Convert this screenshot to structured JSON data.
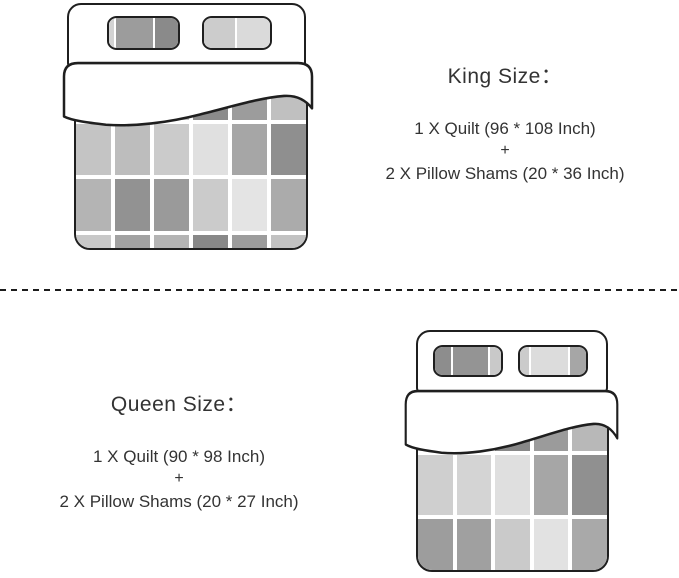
{
  "background": "#ffffff",
  "outline_color": "#1f1f1f",
  "text_color": "#333333",
  "sections": {
    "king": {
      "title": "King Size：",
      "quilt_line": "1 X Quilt (96 * 108 Inch)",
      "plus": "+",
      "shams_line": "2 X Pillow Shams (20 * 36 Inch)"
    },
    "queen": {
      "title": "Queen Size：",
      "quilt_line": "1 X Quilt (90 * 98 Inch)",
      "plus": "+",
      "shams_line": "2 X Pillow Shams (20 * 27 Inch)"
    }
  },
  "beds": {
    "king": {
      "pillows": [
        {
          "segments": [
            {
              "color": "#d3d3d3",
              "grow": 8
            },
            {
              "color": "#9c9c9c",
              "grow": 56
            },
            {
              "color": "#8a8a8a",
              "grow": 36
            }
          ]
        },
        {
          "segments": [
            {
              "color": "#cccccc",
              "grow": 48
            },
            {
              "color": "#dadada",
              "grow": 52
            }
          ]
        }
      ],
      "quilt": {
        "columns": 6,
        "row_heights": [
          30,
          51,
          52,
          13
        ],
        "rows": [
          [
            "#b2b2b2",
            "#a9a9a9",
            "#c2c2c2",
            "#8b8b8b",
            "#9c9c9c",
            "#c0c0c0"
          ],
          [
            "#c4c4c4",
            "#bdbdbd",
            "#cbcbcb",
            "#e0e0e0",
            "#a6a6a6",
            "#8f8f8f"
          ],
          [
            "#b4b4b4",
            "#929292",
            "#9a9a9a",
            "#cbcbcb",
            "#e4e4e4",
            "#ababab"
          ],
          [
            "#c8c8c8",
            "#a2a2a2",
            "#b4b4b4",
            "#888888",
            "#9c9c9c",
            "#c2c2c2"
          ]
        ]
      }
    },
    "queen": {
      "pillows": [
        {
          "segments": [
            {
              "color": "#8d8d8d",
              "grow": 26
            },
            {
              "color": "#949494",
              "grow": 56
            },
            {
              "color": "#c9c9c9",
              "grow": 18
            }
          ]
        },
        {
          "segments": [
            {
              "color": "#cbcbcb",
              "grow": 14
            },
            {
              "color": "#dcdcdc",
              "grow": 60
            },
            {
              "color": "#a6a6a6",
              "grow": 26
            }
          ]
        }
      ],
      "quilt": {
        "columns": 5,
        "row_heights": [
          29,
          61,
          52
        ],
        "rows": [
          [
            "#c0c0c0",
            "#c8c8c8",
            "#888888",
            "#9b9b9b",
            "#b8b8b8"
          ],
          [
            "#cfcfcf",
            "#d4d4d4",
            "#dfdfdf",
            "#a6a6a6",
            "#909090"
          ],
          [
            "#9d9d9d",
            "#a0a0a0",
            "#cacaca",
            "#e2e2e2",
            "#a9a9a9"
          ]
        ]
      }
    }
  }
}
